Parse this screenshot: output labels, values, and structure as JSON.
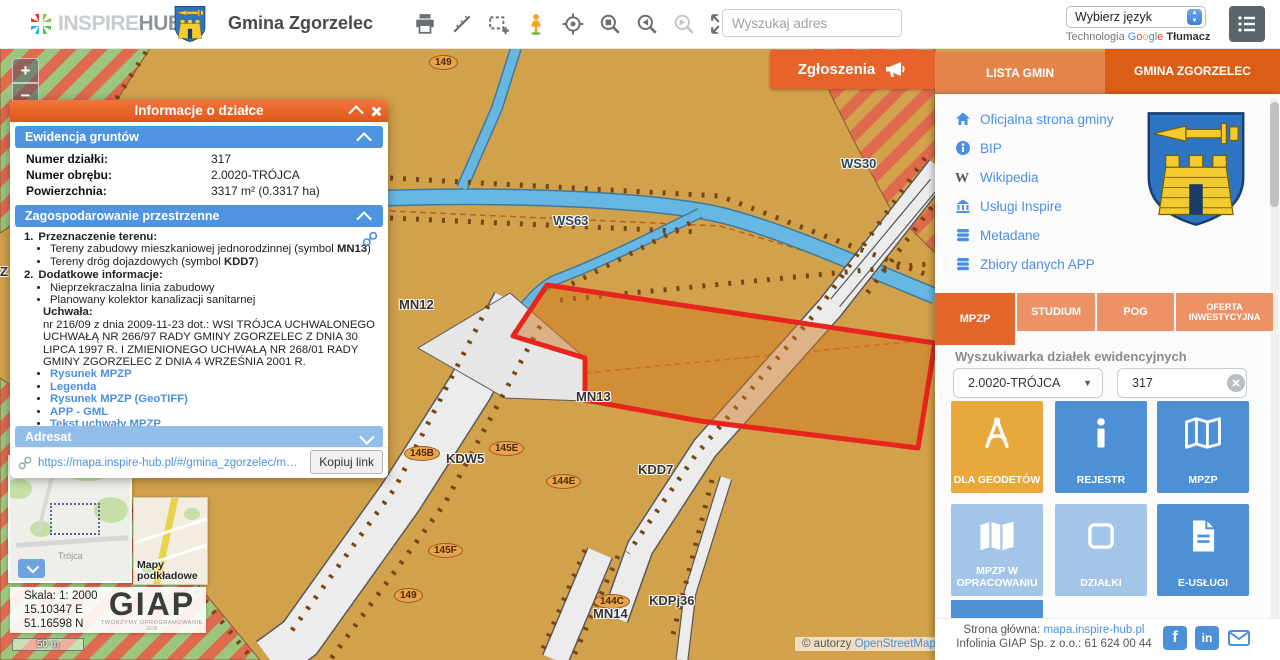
{
  "colors": {
    "accent_orange": "#E8622C",
    "tab_inactive_orange": "#EC9266",
    "section_blue": "#4E94E0",
    "section_blue_light": "#93BEEA",
    "tile_blue": "#4D90D5",
    "tile_light_blue": "#A3C6E8",
    "tile_orange": "#E9A83C",
    "map_base": "#D2A14B",
    "parcel_outline": "#E7251D",
    "water_blue": "#67B7E3",
    "link_blue": "#4A90E2"
  },
  "header": {
    "logo_inspire": "INSPIRE",
    "logo_hub": "HUB",
    "title": "Gmina Zgorzelec",
    "search_placeholder": "Wyszukaj adres",
    "language_select_value": "Wybierz język",
    "translate_prefix": "Technologia",
    "translate_google": [
      "G",
      "o",
      "o",
      "g",
      "l",
      "e"
    ],
    "translate_product": "Tłumacz"
  },
  "map": {
    "zoom_in": "+",
    "zoom_out": "−",
    "reports_button": "Zgłoszenia",
    "labels": [
      {
        "text": "149"
      },
      {
        "text": "WS30"
      },
      {
        "text": "WS63"
      },
      {
        "text": "MN12"
      },
      {
        "text": "MN13"
      },
      {
        "text": "KDW5"
      },
      {
        "text": "145B"
      },
      {
        "text": "145E"
      },
      {
        "text": "144E"
      },
      {
        "text": "KDD7"
      },
      {
        "text": "145F"
      },
      {
        "text": "149"
      },
      {
        "text": "144C"
      },
      {
        "text": "MN14"
      },
      {
        "text": "KDPj36"
      },
      {
        "text": "Z"
      }
    ],
    "overview_place": "Trójca",
    "basemap_label": "Mapy podkładowe",
    "scale_panel": {
      "scale": "Skala: 1: 2000",
      "longitude": "15.10347 E",
      "latitude": "51.16598 N"
    },
    "giap": {
      "name": "GIAP",
      "tagline": "TWORZYMY OPROGRAMOWANIE GIS"
    },
    "scale_bar": "50 m",
    "attribution_prefix": "© autorzy ",
    "attribution_link": "OpenStreetMap"
  },
  "popup": {
    "title": "Informacje o działce",
    "ewidencja": {
      "title": "Ewidencja gruntów",
      "rows": [
        {
          "label": "Numer działki:",
          "value": "317"
        },
        {
          "label": "Numer obrębu:",
          "value": "2.0020-TRÓJCA"
        },
        {
          "label": "Powierzchnia:",
          "value": "3317 m² (0.3317 ha)"
        }
      ]
    },
    "planning": {
      "title": "Zagospodarowanie przestrzenne",
      "item1_no": "1.",
      "item1_title": "Przeznaczenie terenu:",
      "item1_bullets": [
        {
          "pre": "Tereny zabudowy mieszkaniowej jednorodzinnej (symbol ",
          "bold": "MN13",
          "post": ")"
        },
        {
          "pre": "Tereny dróg dojazdowych (symbol ",
          "bold": "KDD7",
          "post": ")"
        }
      ],
      "item2_no": "2.",
      "item2_title": "Dodatkowe informacje:",
      "item2_bullets": [
        "Nieprzekraczalna linia zabudowy",
        "Planowany kolektor kanalizacji sanitarnej"
      ],
      "resolution_label": "Uchwała:",
      "resolution_text": "nr 216/09 z dnia 2009-11-23 dot.: WSI TRÓJCA UCHWALONEGO UCHWAŁĄ NR 266/97 RADY GMINY ZGORZELEC Z DNIA 30 LIPCA 1997 R. I ZMIENIONEGO UCHWAŁĄ NR 268/01 RADY GMINY ZGORZELEC Z DNIA 4 WRZEŚNIA 2001 R.",
      "links": [
        "Rysunek MPZP",
        "Legenda",
        "Rysunek MPZP (GeoTIFF)",
        "APP - GML",
        "Tekst uchwały MPZP"
      ]
    },
    "adresat_title": "Adresat",
    "share_url": "https://mapa.inspire-hub.pl/#/gmina_zgorzelec/mpzp/dzi...",
    "copy_link_button": "Kopiuj link"
  },
  "sidebar": {
    "tabs": [
      {
        "label": "LISTA GMIN"
      },
      {
        "label": "GMINA ZGORZELEC"
      }
    ],
    "links": [
      {
        "label": "Oficjalna strona gminy"
      },
      {
        "label": "BIP"
      },
      {
        "label": "Wikipedia"
      },
      {
        "label": "Usługi Inspire"
      },
      {
        "label": "Metadane"
      },
      {
        "label": "Zbiory danych APP"
      }
    ],
    "plan_tabs": [
      {
        "label": "MPZP"
      },
      {
        "label": "STUDIUM"
      },
      {
        "label": "POG"
      },
      {
        "label": "OFERTA INWESTYCYJNA"
      }
    ],
    "search_title": "Wyszukiwarka działek ewidencyjnych",
    "precinct_value": "2.0020-TRÓJCA",
    "parcel_value": "317",
    "tiles": [
      {
        "label": "DLA GEODETÓW"
      },
      {
        "label": "REJESTR"
      },
      {
        "label": "MPZP"
      },
      {
        "label": "MPZP W OPRACOWANIU"
      },
      {
        "label": "DZIAŁKI"
      },
      {
        "label": "E-USŁUGI"
      }
    ],
    "footer": {
      "home_label": "Strona główna: ",
      "home_link": "mapa.inspire-hub.pl",
      "infoline": "Infolinia GIAP Sp. z o.o.: 61 624 00 44"
    }
  }
}
